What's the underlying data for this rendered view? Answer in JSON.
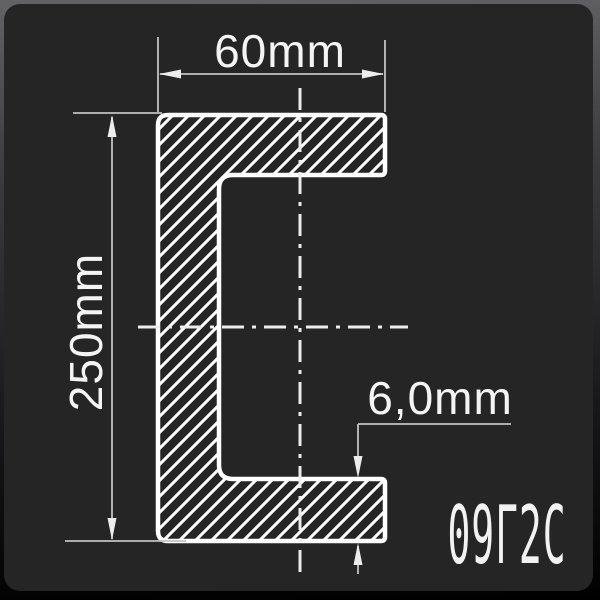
{
  "drawing": {
    "dimensions": {
      "width": "60mm",
      "height": "250mm",
      "thickness": "6,0mm"
    },
    "steel_grade": "09Г2С",
    "colors": {
      "panel_background": "#252526",
      "frame_gradient_top": "#636365",
      "frame_gradient_bottom": "#000000",
      "profile_outline": "#ffffff",
      "hatch_lines": "#ffffff",
      "dimension_lines": "#c2c2c2",
      "centerlines": "#ececec",
      "text": "#f4f4f4"
    }
  }
}
